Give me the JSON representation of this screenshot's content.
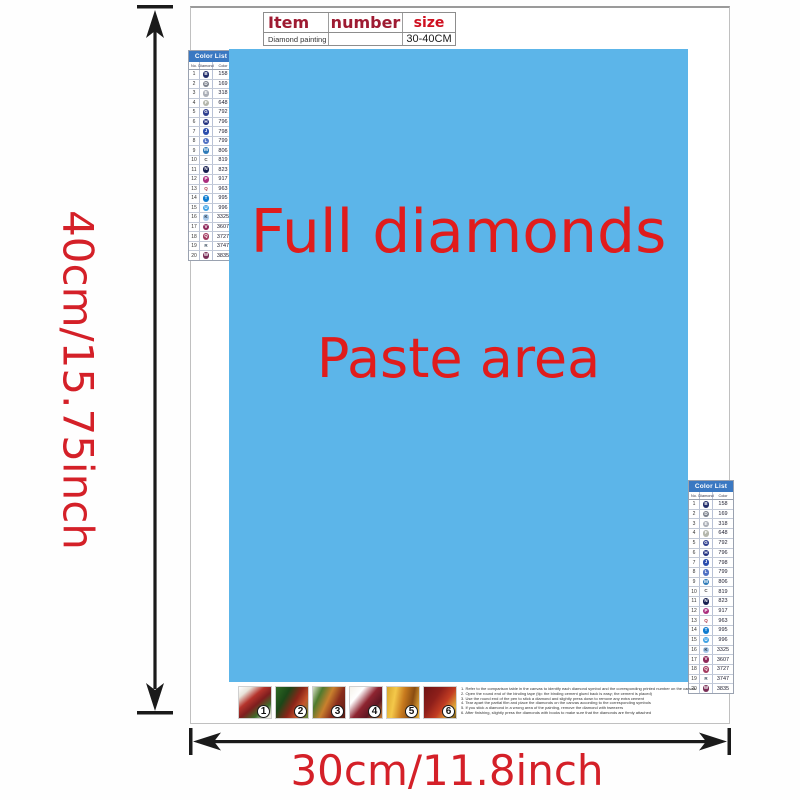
{
  "spec_table": {
    "headers": [
      "Item",
      "number",
      "size"
    ],
    "row": [
      "Diamond painting",
      "",
      "30-40CM"
    ]
  },
  "paste_area": {
    "line1": "Full diamonds",
    "line2": "Paste area",
    "bg": "#5cb5e9",
    "text_color": "#e01c1c"
  },
  "dimensions": {
    "height_label": "40cm/15.75inch",
    "width_label": "30cm/11.8inch",
    "color": "#d42028"
  },
  "color_list": {
    "title": "Color List",
    "columns": [
      "No.",
      "Diamond",
      "Color"
    ],
    "header_bg": "#3a78c2",
    "rows": [
      {
        "n": "1",
        "ch": "B",
        "bg": "#232f6b",
        "fg": "#ffffff",
        "code": "158"
      },
      {
        "n": "2",
        "ch": "D",
        "bg": "#7b818c",
        "fg": "#ffffff",
        "code": "169"
      },
      {
        "n": "3",
        "ch": "E",
        "bg": "#a9adb5",
        "fg": "#ffffff",
        "code": "318"
      },
      {
        "n": "4",
        "ch": "F",
        "bg": "#b3b6ab",
        "fg": "#ffffff",
        "code": "648"
      },
      {
        "n": "5",
        "ch": "G",
        "bg": "#2f3f8e",
        "fg": "#ffffff",
        "code": "792"
      },
      {
        "n": "6",
        "ch": "H",
        "bg": "#1f2e7d",
        "fg": "#ffffff",
        "code": "796"
      },
      {
        "n": "7",
        "ch": "J",
        "bg": "#2b4dad",
        "fg": "#ffffff",
        "code": "798"
      },
      {
        "n": "8",
        "ch": "L",
        "bg": "#4f70c3",
        "fg": "#ffffff",
        "code": "799"
      },
      {
        "n": "9",
        "ch": "M",
        "bg": "#2d7ab8",
        "fg": "#ffffff",
        "code": "806"
      },
      {
        "n": "10",
        "ch": "C",
        "bg": "transparent",
        "fg": "#444444",
        "code": "819"
      },
      {
        "n": "11",
        "ch": "N",
        "bg": "#171f50",
        "fg": "#ffffff",
        "code": "823"
      },
      {
        "n": "12",
        "ch": "P",
        "bg": "#ab2e7e",
        "fg": "#ffffff",
        "code": "917"
      },
      {
        "n": "13",
        "ch": "Q",
        "bg": "transparent",
        "fg": "#aa3344",
        "code": "963"
      },
      {
        "n": "14",
        "ch": "T",
        "bg": "#0e7cd0",
        "fg": "#ffffff",
        "code": "995"
      },
      {
        "n": "15",
        "ch": "U",
        "bg": "#3ea2e5",
        "fg": "#ffffff",
        "code": "996"
      },
      {
        "n": "16",
        "ch": "K",
        "bg": "#a6c8ea",
        "fg": "#223344",
        "code": "3325"
      },
      {
        "n": "17",
        "ch": "V",
        "bg": "#8e2a5b",
        "fg": "#ffffff",
        "code": "3607"
      },
      {
        "n": "18",
        "ch": "Q",
        "bg": "#a23a60",
        "fg": "#ffffff",
        "code": "3727"
      },
      {
        "n": "19",
        "ch": "R",
        "bg": "transparent",
        "fg": "#445566",
        "code": "3747"
      },
      {
        "n": "20",
        "ch": "W",
        "bg": "#7a2e57",
        "fg": "#ffffff",
        "code": "3835"
      }
    ]
  },
  "steps": [
    {
      "n": "1",
      "bg": "linear-gradient(140deg,#ffffff 0%,#e8e4da 18%,#b5342c 38%,#7e1e1e 55%,#3f6d2a 75%,#f2efe6 95%)"
    },
    {
      "n": "2",
      "bg": "linear-gradient(120deg,#2e6b24 0%,#1b4718 30%,#8a2418 55%,#c6552c 75%,#5d8f3a 100%)"
    },
    {
      "n": "3",
      "bg": "linear-gradient(115deg,#d8e0c8 0%,#4f7a2e 22%,#c9802d 45%,#8a2d1c 68%,#5a1c14 100%)"
    },
    {
      "n": "4",
      "bg": "linear-gradient(130deg,#f5f2ea 0%,#ffffff 25%,#8e2430 50%,#5e1622 72%,#c87f33 100%)"
    },
    {
      "n": "5",
      "bg": "linear-gradient(100deg,#d8a52c 0%,#f4c84a 25%,#c87a1e 50%,#8a4d12 75%,#f0b73c 100%)"
    },
    {
      "n": "6",
      "bg": "linear-gradient(125deg,#6e1414 0%,#8e1f1a 35%,#c23c22 60%,#e2b23a 85%,#6b4a12 100%)"
    }
  ],
  "instructions": {
    "lines": [
      "1. Refer to the comparison table in the canvas to identify each diamond symbol and the corresponding printed number on the canvas",
      "2. Open the round end of the binding tape (tip: the binding cement glued back is easy; the cement is placed)",
      "3. Use the round end of the pen to stick a diamond and slightly press down to remove any extra cement",
      "4. Tear apart the partial film and place the diamonds on the canvas according to the corresponding symbols",
      "5. If you stick a diamond in a wrong area of the painting, remove the diamond with tweezers",
      "6. After finishing, slightly press the diamonds with books to make sure that the diamonds are firmly attached"
    ]
  }
}
